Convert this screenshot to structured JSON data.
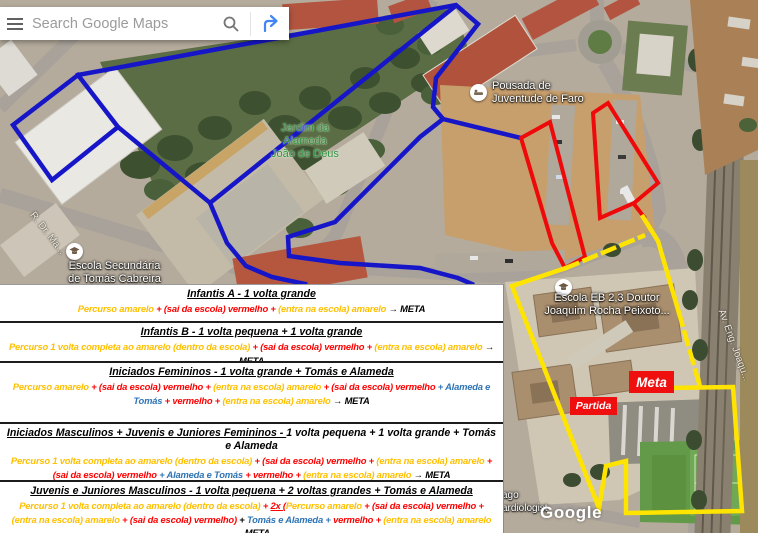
{
  "colors": {
    "route_blue": "#1616c8",
    "route_red": "#ee0a0a",
    "route_yellow": "#ffe400",
    "panel_yellow": "#FFC000",
    "panel_red": "#FF0000",
    "panel_blue": "#2E74B5",
    "directions_blue": "#4285F4",
    "marker_red": "#ef0f0f"
  },
  "search": {
    "placeholder": "Search Google Maps"
  },
  "map": {
    "labels": {
      "park": [
        "Jardim da",
        "Alameda",
        "João de Deus"
      ],
      "pousada": [
        "Pousada de",
        "Juventude de Faro"
      ],
      "escola_secundaria": [
        "Escola Secundária",
        "de Tomás Cabreira"
      ],
      "escola_eb": [
        "Escola EB 2,3 Doutor",
        "Joaquim Rocha Peixoto..."
      ],
      "road_avenue": "Av. Eng. Joaqu...",
      "road_r_dr": "R. Dr. Ma...",
      "partial_poi": [
        "ago",
        "ardiologist"
      ],
      "watermark": "Google"
    },
    "markers": {
      "start": "Partida",
      "finish": "Meta"
    },
    "icons": {
      "menu": "hamburger-menu",
      "search": "magnifier",
      "directions": "directions-fork-arrow",
      "school": "graduation-cap",
      "hostel": "bed"
    }
  },
  "panel": {
    "sections": [
      {
        "heading": [
          {
            "t": "Infantis A - 1 volta grande",
            "c": "k",
            "u": true
          }
        ],
        "body": [
          {
            "t": "Percurso amarelo ",
            "c": "y"
          },
          {
            "t": "+ (sai da escola) vermelho + ",
            "c": "r"
          },
          {
            "t": "(entra na escola) amarelo ",
            "c": "y"
          },
          {
            "t": "→ META",
            "c": "k"
          }
        ]
      },
      {
        "heading": [
          {
            "t": "Infantis B - 1 volta pequena + 1 volta grande",
            "c": "k",
            "u": true
          }
        ],
        "body": [
          {
            "t": "Percurso 1 volta completa ao amarelo (dentro da escola) ",
            "c": "y"
          },
          {
            "t": "+ (sai da escola) vermelho + ",
            "c": "r"
          },
          {
            "t": "(entra na escola) amarelo ",
            "c": "y"
          },
          {
            "t": "→ META",
            "c": "k"
          }
        ]
      },
      {
        "heading": [
          {
            "t": "Iniciados Femininos - 1 volta grande + Tomás e Alameda",
            "c": "k",
            "u": true
          }
        ],
        "body": [
          {
            "t": "Percurso amarelo ",
            "c": "y"
          },
          {
            "t": "+ (sai da escola) vermelho + ",
            "c": "r"
          },
          {
            "t": "(entra na escola) amarelo ",
            "c": "y"
          },
          {
            "t": "+ (sai da escola) vermelho ",
            "c": "r"
          },
          {
            "t": "+ Alameda e Tomás ",
            "c": "b"
          },
          {
            "t": "+ vermelho + ",
            "c": "r"
          },
          {
            "t": "(entra na escola) amarelo ",
            "c": "y"
          },
          {
            "t": "→ META",
            "c": "k"
          }
        ]
      },
      {
        "heading": [
          {
            "t": "Iniciados Masculinos + Juvenis e Juniores Femininos - ",
            "c": "k",
            "u": true
          },
          {
            "t": "1 volta pequena + 1 volta grande + Tomás e Alameda",
            "c": "k",
            "u": false
          }
        ],
        "body": [
          {
            "t": "Percurso 1 volta completa ao amarelo (dentro da escola) ",
            "c": "y"
          },
          {
            "t": "+ (sai da escola) vermelho + ",
            "c": "r"
          },
          {
            "t": "(entra na escola) amarelo ",
            "c": "y"
          },
          {
            "t": "+ (sai da escola) vermelho ",
            "c": "r"
          },
          {
            "t": "+ Alameda e Tomás ",
            "c": "b"
          },
          {
            "t": "+ vermelho + ",
            "c": "r"
          },
          {
            "t": "(entra na escola) amarelo ",
            "c": "y"
          },
          {
            "t": "→ META",
            "c": "k"
          }
        ]
      },
      {
        "heading": [
          {
            "t": "Juvenis e Juniores Masculinos - 1 volta pequena + 2 voltas grandes + Tomás e Alameda",
            "c": "k",
            "u": true
          }
        ],
        "body": [
          {
            "t": "Percurso 1 volta completa ao amarelo (dentro da escola)  ",
            "c": "y"
          },
          {
            "t": "+ ",
            "c": "r"
          },
          {
            "t": "2x (",
            "c": "r",
            "u": true
          },
          {
            "t": "Percurso amarelo ",
            "c": "y"
          },
          {
            "t": "+ (sai da escola) vermelho + ",
            "c": "r"
          },
          {
            "t": "(entra na escola) amarelo ",
            "c": "y"
          },
          {
            "t": "+ (sai da escola) vermelho) ",
            "c": "r"
          },
          {
            "t": "+ ",
            "c": "k"
          },
          {
            "t": "Tomás e Alameda ",
            "c": "b"
          },
          {
            "t": "+ ",
            "c": "b"
          },
          {
            "t": "vermelho + ",
            "c": "r"
          },
          {
            "t": "(entra na escola) amarelo ",
            "c": "y"
          },
          {
            "t": "→ META",
            "c": "k"
          }
        ]
      }
    ]
  }
}
